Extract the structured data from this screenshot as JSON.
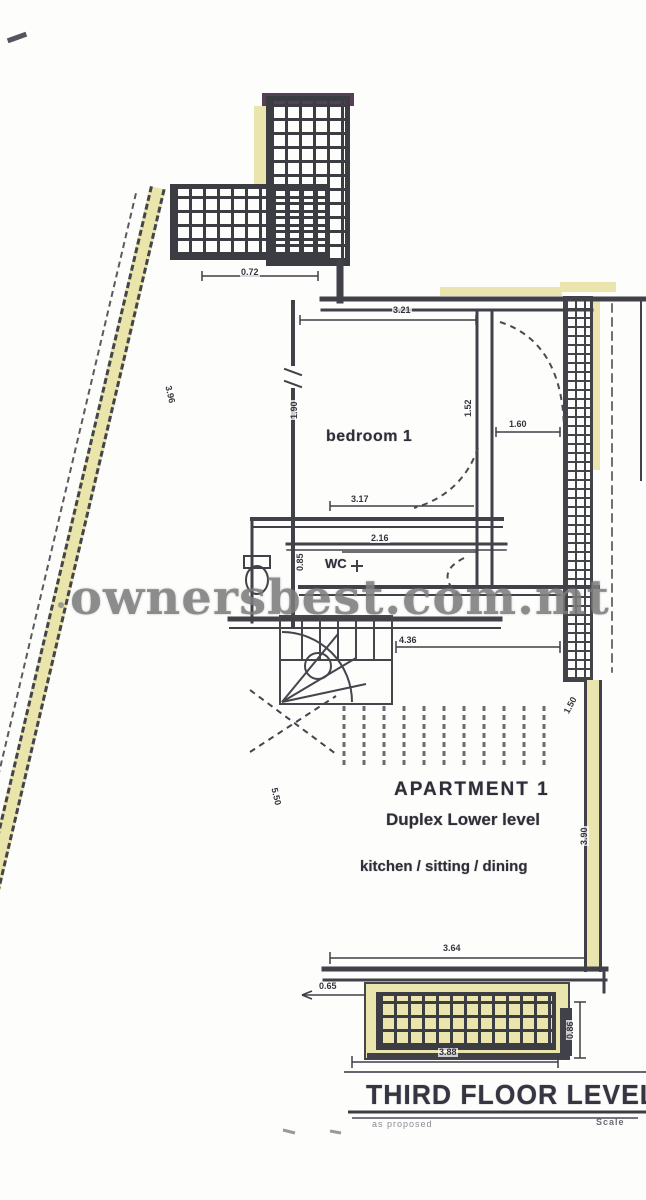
{
  "watermark": "ownersbest.com.mt",
  "title_block": {
    "title": "THIRD FLOOR LEVEL",
    "subtitle": "as proposed",
    "scale_label": "Scale"
  },
  "rooms": {
    "bedroom": "bedroom 1",
    "wc": "WC",
    "apartment_line1": "APARTMENT 1",
    "apartment_line2": "Duplex Lower level",
    "apartment_line3": "kitchen / sitting / dining"
  },
  "dimensions": {
    "terrace_bottom": "0.72",
    "bedroom_top": "3.21",
    "bedroom_left": "1.90",
    "bedroom_right": "1.52",
    "hall_right": "1.60",
    "bedroom_bottom": "3.17",
    "wc_top": "2.16",
    "wc_left": "0.85",
    "stair_width": "4.36",
    "right_upper": "1.50",
    "boundary_upper": "3.96",
    "boundary_lower": "5.50",
    "right_lower": "3.90",
    "room_bottom": "3.64",
    "balcony_left": "0.65",
    "balcony_bottom": "3.88",
    "balcony_right": "0.86"
  },
  "colors": {
    "line": "#41414a",
    "highlight": "#eae5ac",
    "shaft_cap": "#564057",
    "watermark": "#7d7d7d"
  }
}
